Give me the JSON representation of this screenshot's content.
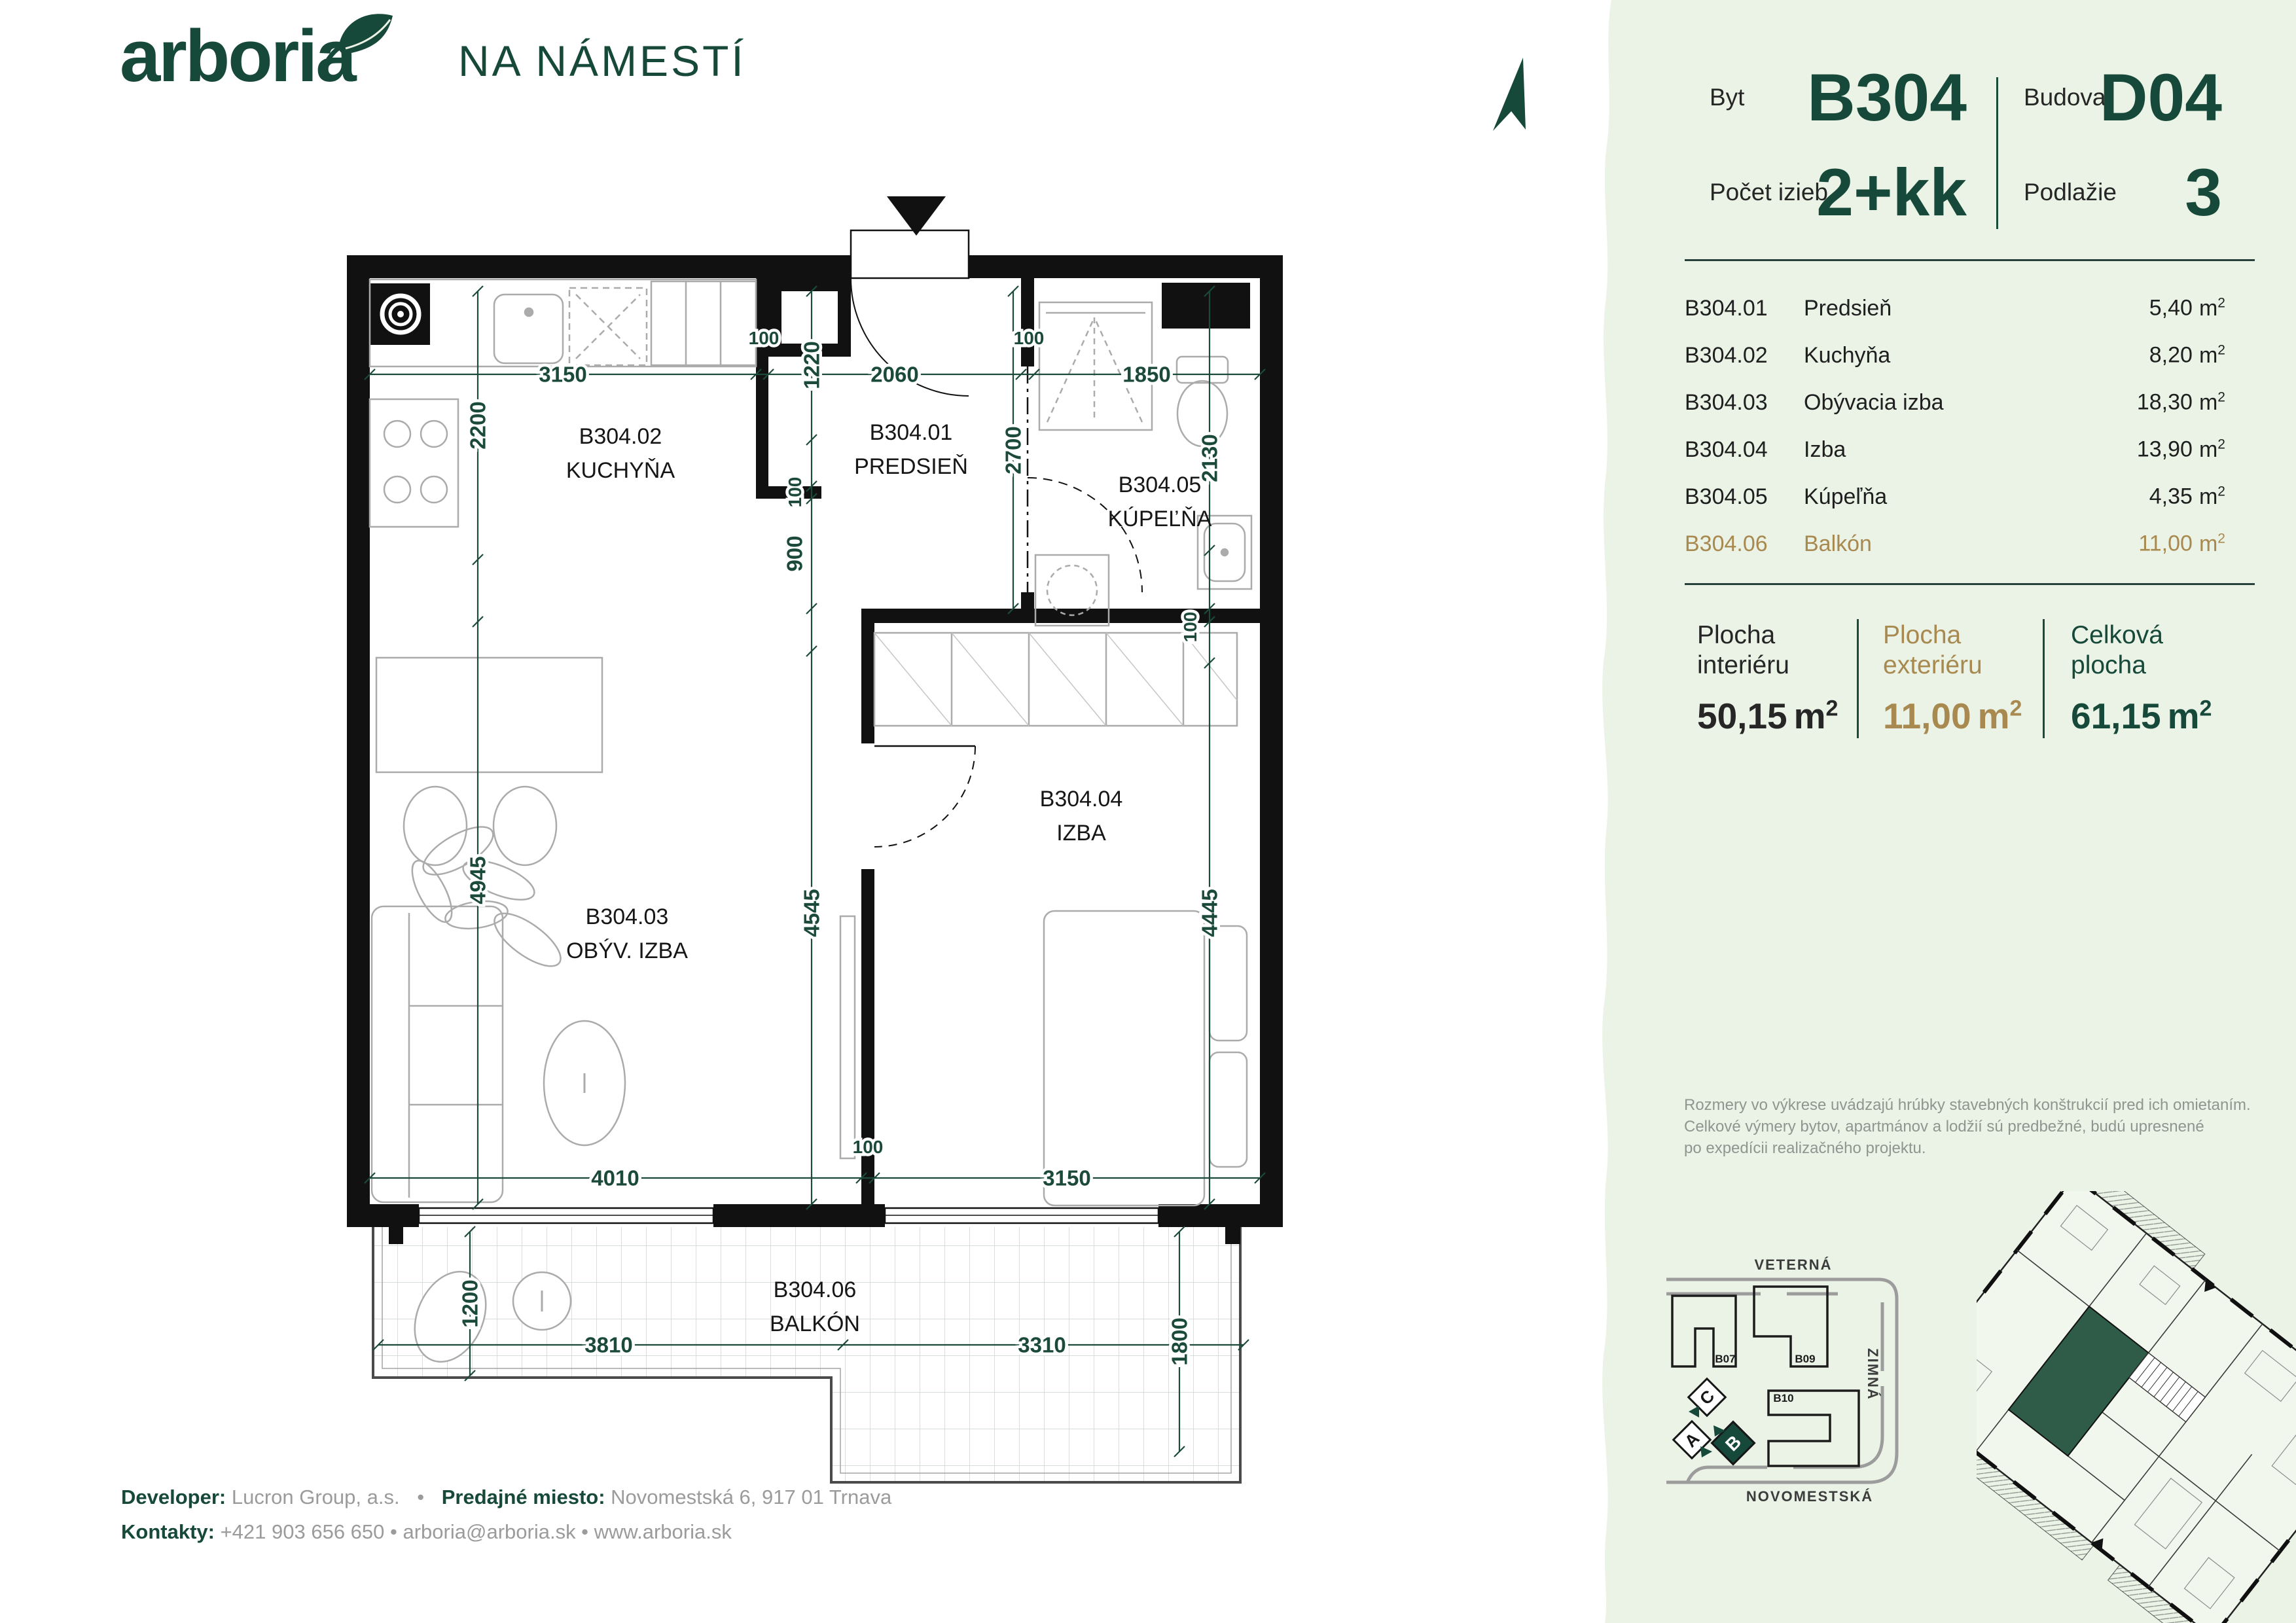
{
  "logo": {
    "wordmark": "arboria",
    "project": "NA NÁMESTÍ"
  },
  "unit_info": {
    "byt_label": "Byt",
    "byt_value": "B304",
    "budova_label": "Budova",
    "budova_value": "D04",
    "izby_label": "Počet izieb",
    "izby_value": "2+kk",
    "podlazie_label": "Podlažie",
    "podlazie_value": "3"
  },
  "room_table": {
    "unit": "m",
    "unit_sup": "2",
    "rows": [
      {
        "code": "B304.01",
        "name": "Predsieň",
        "area": "5,40"
      },
      {
        "code": "B304.02",
        "name": "Kuchyňa",
        "area": "8,20"
      },
      {
        "code": "B304.03",
        "name": "Obývacia izba",
        "area": "18,30"
      },
      {
        "code": "B304.04",
        "name": "Izba",
        "area": "13,90"
      },
      {
        "code": "B304.05",
        "name": "Kúpeľňa",
        "area": "4,35"
      },
      {
        "code": "B304.06",
        "name": "Balkón",
        "area": "11,00"
      }
    ]
  },
  "summary": {
    "unit": "m",
    "unit_sup": "2",
    "cols": [
      {
        "label1": "Plocha",
        "label2": "interiéru",
        "value": "50,15"
      },
      {
        "label1": "Plocha",
        "label2": "exteriéru",
        "value": "11,00"
      },
      {
        "label1": "Celková",
        "label2": "plocha",
        "value": "61,15"
      }
    ]
  },
  "disclaimer": {
    "lines": [
      "Rozmery vo výkrese uvádzajú hrúbky stavebných konštrukcií pred ich omietaním.",
      "Celkové výmery bytov, apartmánov a lodžií sú predbežné, budú upresnené",
      "po expedícii realizačného projektu."
    ]
  },
  "footer": {
    "developer_label": "Developer:",
    "developer_value": "Lucron Group, a.s.",
    "separator": "•",
    "miesto_label": "Predajné miesto:",
    "miesto_value": "Novomestská 6, 917 01  Trnava",
    "kontakty_label": "Kontakty:",
    "kontakty_value": "+421 903 656 650 • arboria@arboria.sk • www.arboria.sk"
  },
  "plan": {
    "rooms": [
      {
        "code": "B304.02",
        "name": "KUCHYŇA"
      },
      {
        "code": "B304.01",
        "name": "PREDSIEŇ"
      },
      {
        "code": "B304.05",
        "name": "KÚPEĽŇA"
      },
      {
        "code": "B304.03",
        "name": "OBÝV. IZBA"
      },
      {
        "code": "B304.04",
        "name": "IZBA"
      },
      {
        "code": "B304.06",
        "name": "BALKÓN"
      }
    ],
    "dims": {
      "d3150t": "3150",
      "d100a": "100",
      "d2060": "2060",
      "d100b": "100",
      "d1850": "1850",
      "d2200": "2200",
      "d1220": "1220",
      "d2700": "2700",
      "d2130": "2130",
      "d100c": "100",
      "d900": "900",
      "d100d": "100",
      "d4945": "4945",
      "d4545": "4545",
      "d4445": "4445",
      "d4010": "4010",
      "d100e": "100",
      "d3150b": "3150",
      "d1200": "1200",
      "d3810": "3810",
      "d3310": "3310",
      "d1800": "1800"
    }
  },
  "site_map": {
    "street_top": "VETERNÁ",
    "street_right": "ZIMNÁ",
    "street_bottom": "NOVOMESTSKÁ",
    "buildings": {
      "b07": "B07",
      "b09": "B09",
      "b10": "B10"
    },
    "blocks": {
      "c": "C",
      "a": "A",
      "b": "B"
    }
  }
}
